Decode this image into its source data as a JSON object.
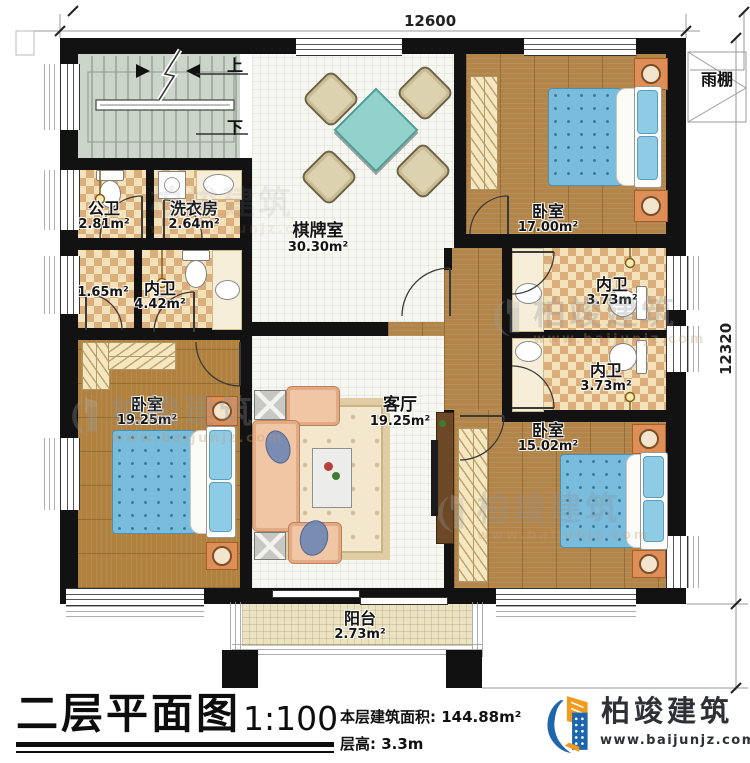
{
  "plan": {
    "dim_top": "12600",
    "dim_right": "12320",
    "stair_up": "上",
    "stair_down": "下",
    "canopy_label": "雨棚",
    "rooms": {
      "public_bath": {
        "name": "公卫",
        "area": "2.81m²"
      },
      "laundry": {
        "name": "洗衣房",
        "area": "2.64m²"
      },
      "game_room": {
        "name": "棋牌室",
        "area": "30.30m²"
      },
      "bedroom_top_right": {
        "name": "卧室",
        "area": "17.00m²"
      },
      "closet": {
        "area": "1.65m²"
      },
      "inner_bath_left": {
        "name": "内卫",
        "area": "4.42m²"
      },
      "inner_bath_right_1": {
        "name": "内卫",
        "area": "3.73m²"
      },
      "inner_bath_right_2": {
        "name": "内卫",
        "area": "3.73m²"
      },
      "bedroom_bottom_left": {
        "name": "卧室",
        "area": "19.25m²"
      },
      "living_room": {
        "name": "客厅",
        "area": "19.25m²"
      },
      "bedroom_bottom_right": {
        "name": "卧室",
        "area": "15.02m²"
      },
      "balcony": {
        "name": "阳台",
        "area": "2.73m²"
      }
    }
  },
  "titleblock": {
    "title": "二层平面图",
    "scale": "1:100",
    "floor_area_label": "本层建筑面积:",
    "floor_area_value": "144.88m²",
    "floor_height_label": "层高:",
    "floor_height_value": "3.3m"
  },
  "brand": {
    "name": "柏竣建筑",
    "website": "www.baijunjz.com"
  },
  "watermark": {
    "text": "柏竣建筑",
    "website": "www.baijunjz.com"
  },
  "colors": {
    "wall": "#121212",
    "wood_floor": "#b0813f",
    "tile_cream": "#f4e2ba",
    "tile_tan": "#dcae7c",
    "bed_blue": "#79bcdb",
    "table_teal": "#92d2cb",
    "logo_blue": "#1d66ae",
    "logo_orange": "#f29a1c"
  }
}
